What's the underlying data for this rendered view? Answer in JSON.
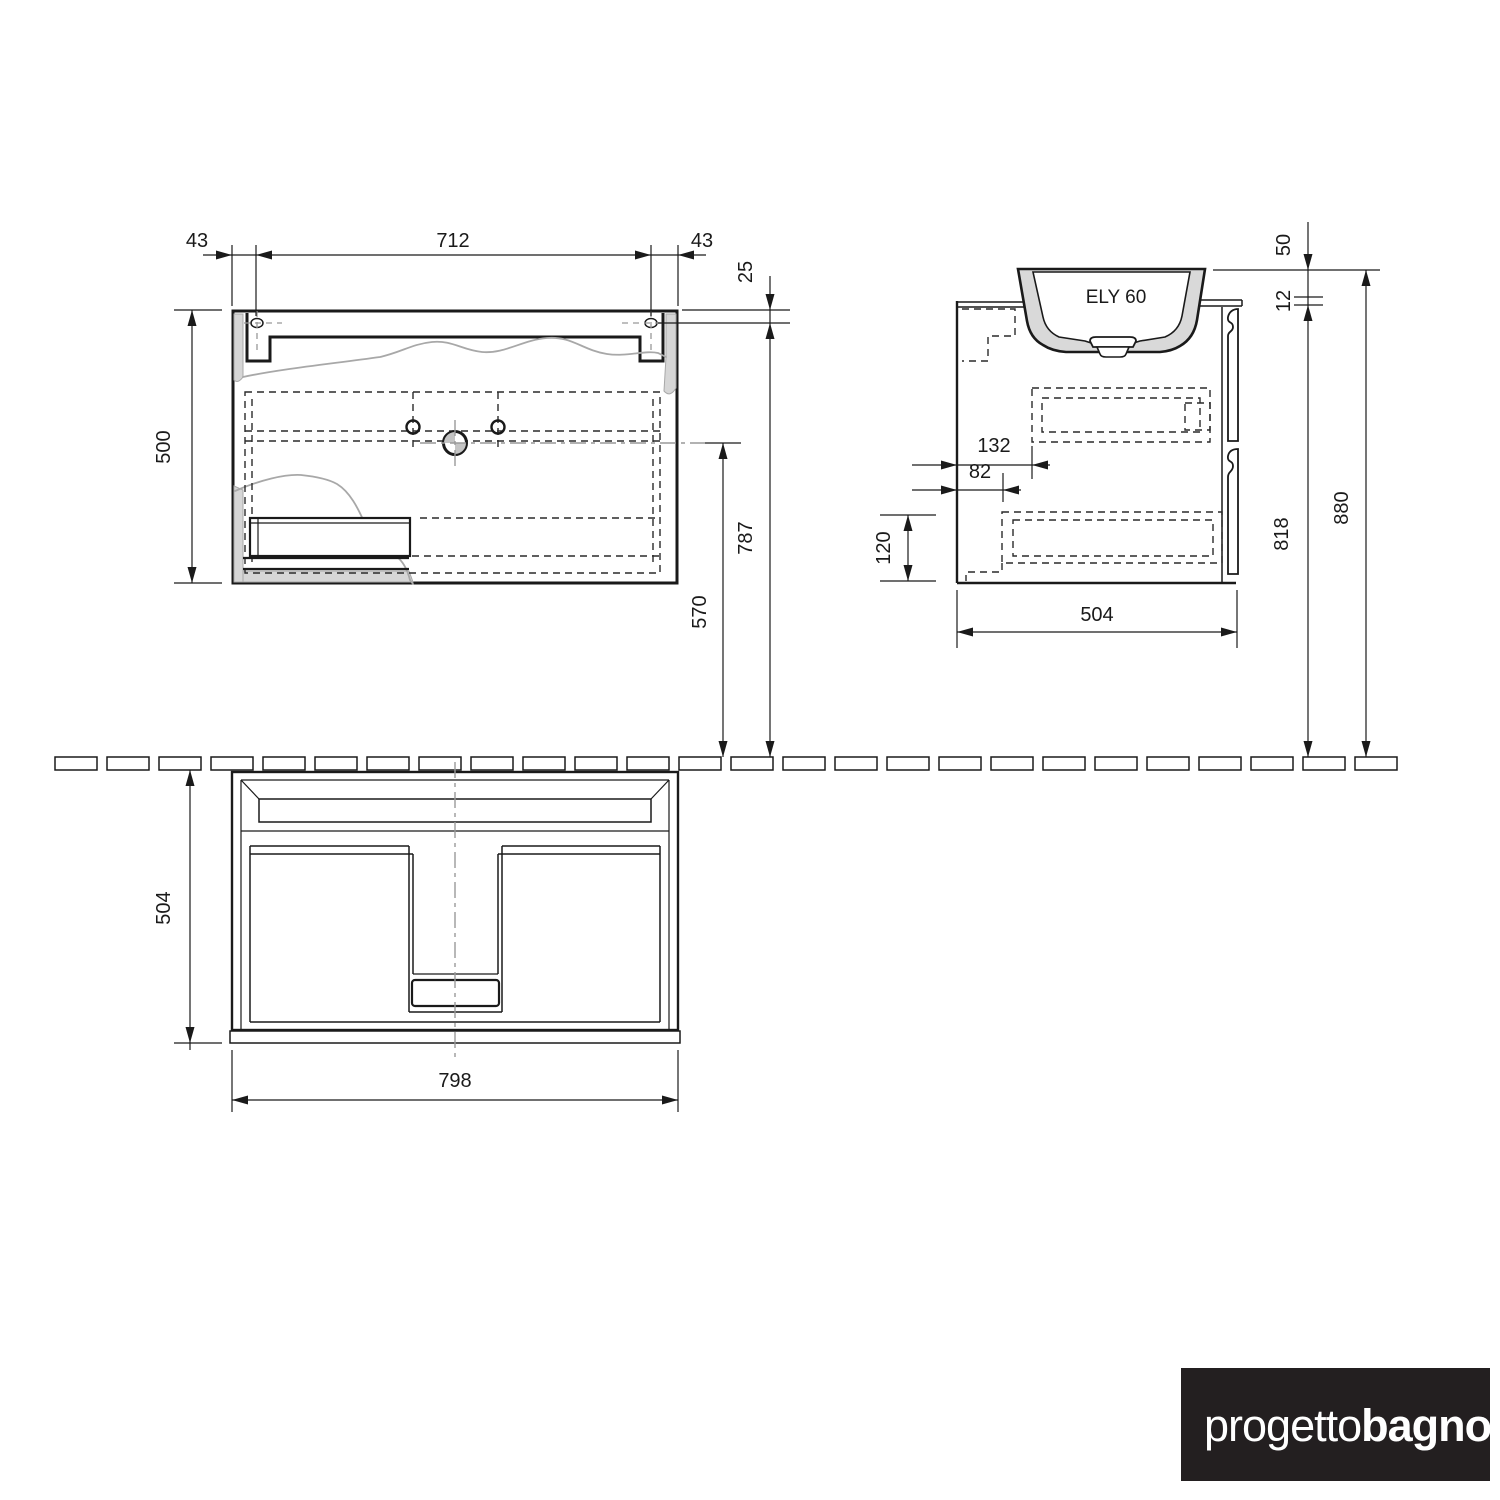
{
  "drawing_title": "ELY 60",
  "views": {
    "basin_plan": {
      "dims": {
        "overhang_left": "43",
        "hole_span": "712",
        "overhang_right": "43",
        "depth": "500",
        "hole_inset": "25"
      }
    },
    "elevation": {
      "dims": {
        "drain_height": "570",
        "hole_height": "787"
      }
    },
    "side": {
      "model_label": "ELY 60",
      "dims": {
        "basin_rim": "50",
        "top_gap": "12",
        "clearance_back": "132",
        "clearance_front": "82",
        "base_height": "120",
        "depth": "504",
        "body_height": "818",
        "total_height": "880"
      }
    },
    "cabinet_plan": {
      "dims": {
        "depth": "504",
        "width": "798"
      }
    },
    "wall_section": {
      "tile_count": 26
    }
  },
  "logo": {
    "regular": "progetto",
    "bold": "bagno",
    "background": "#231f20",
    "foreground": "#ffffff"
  },
  "colors": {
    "line": "#1a1a1a",
    "section_fill": "#d6d6d6",
    "break_line": "#a8a8a8",
    "centerline": "#999999"
  }
}
